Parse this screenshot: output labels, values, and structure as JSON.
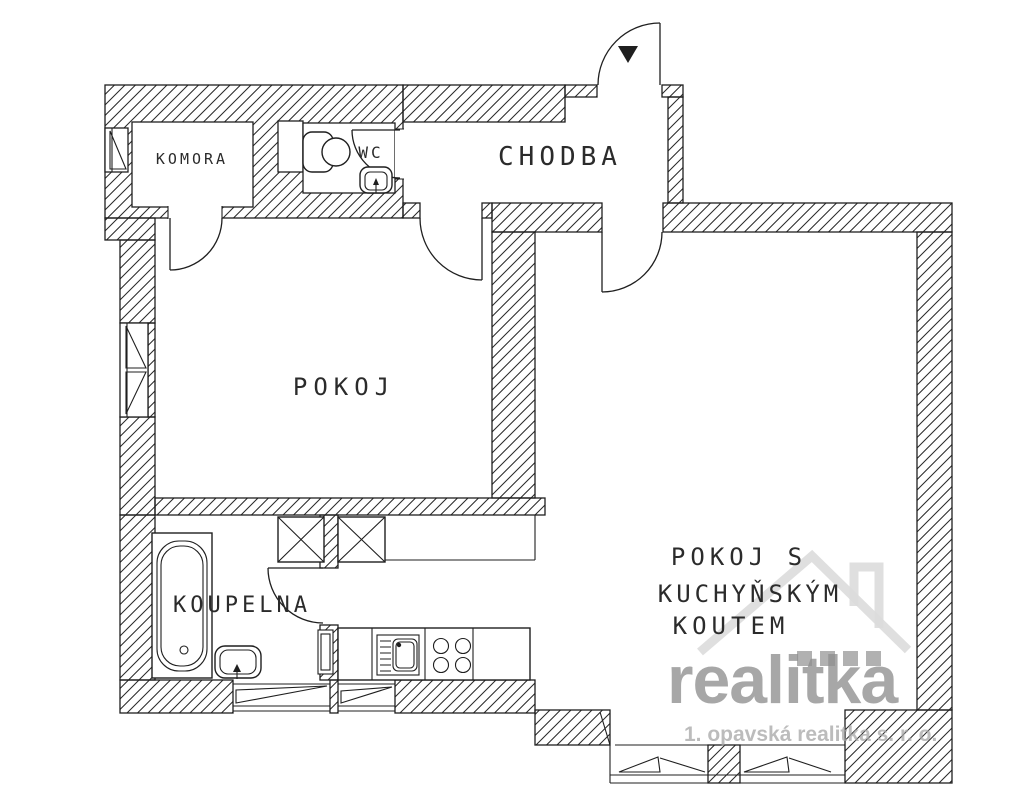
{
  "title": "Byt 2+kk - půdorys",
  "colors": {
    "line": "#1f1f1f",
    "watermark_brand": "#8f8f8f",
    "watermark_sub": "#a6a6a6",
    "logo_light": "#dcdcdc",
    "logo_dark": "#909090"
  },
  "rooms": {
    "komora": {
      "label": "KOMORA"
    },
    "wc": {
      "label": "WC"
    },
    "chodba": {
      "label": "CHODBA"
    },
    "pokoj": {
      "label": "POKOJ"
    },
    "koupelna": {
      "label": "KOUPELNA"
    },
    "pokoj_kk": {
      "line1": "POKOJ S",
      "line2": "KUCHYŇSKÝM",
      "line3": "KOUTEM"
    }
  },
  "fixtures": {
    "bathtub": "bathtub",
    "washbasin": "washbasin",
    "toilet": "toilet",
    "wc_basin": "wc-washbasin",
    "kitchen_sink": "kitchen-sink",
    "stove": "stove-4-burners",
    "shafts": "ventilation-shafts",
    "entrance_marker": "entrance-triangle"
  },
  "watermark": {
    "brand": "realitka",
    "subtitle": "1. opavská realitka s. r. o."
  }
}
